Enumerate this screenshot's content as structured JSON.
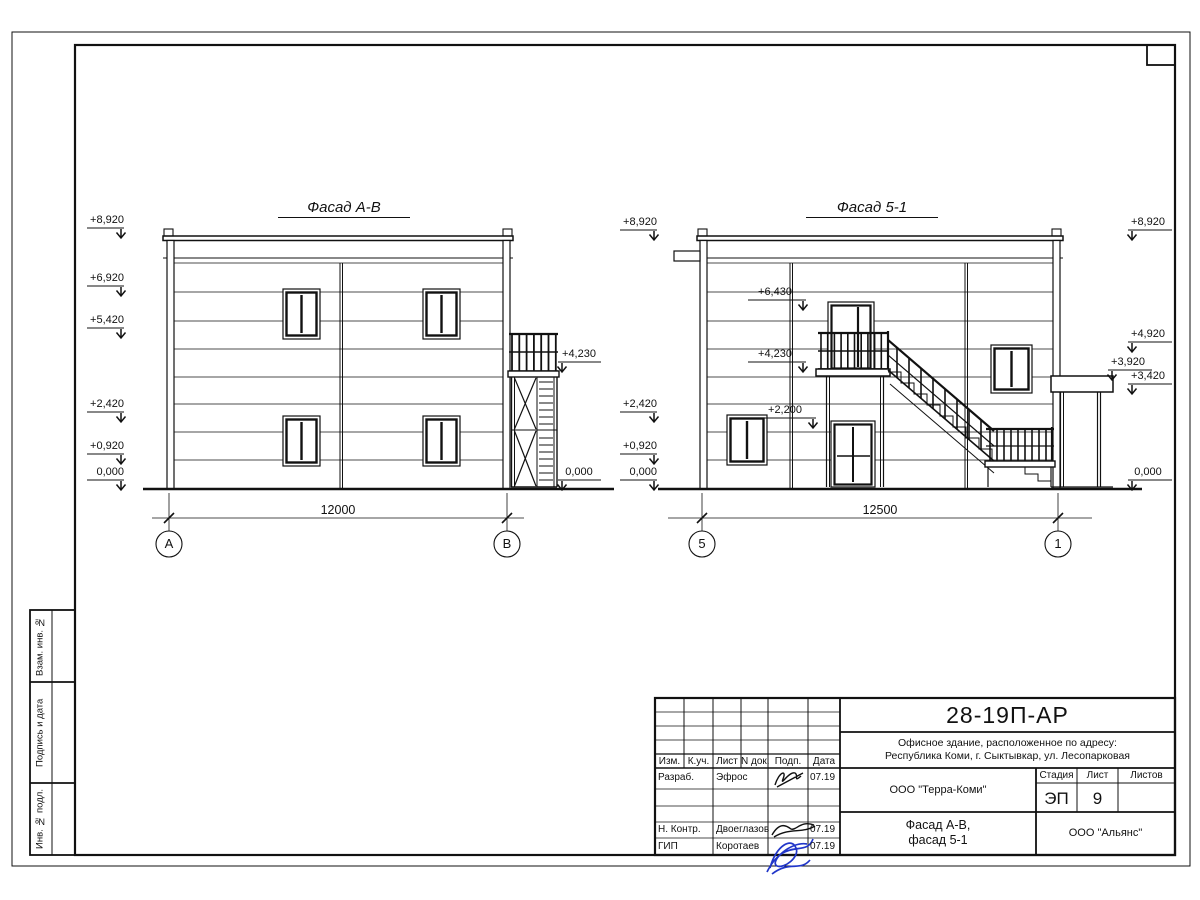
{
  "titleblock": {
    "doc_number": "28-19П-АР",
    "address_line1": "Офисное здание, расположенное по адресу:",
    "address_line2": "Республика Коми, г. Сыктывкар, ул. Лесопарковая",
    "columns": [
      "Изм.",
      "К.уч.",
      "Лист",
      "N док.",
      "Подп.",
      "Дата"
    ],
    "rows": [
      {
        "role": "Разраб.",
        "name": "Эфрос",
        "date": "07.19"
      },
      {
        "role": "Н. Контр.",
        "name": "Двоеглазов",
        "date": "07.19"
      },
      {
        "role": "ГИП",
        "name": "Коротаев",
        "date": "07.19"
      }
    ],
    "org": "ООО \"Терра-Коми\"",
    "stage_label": "Стадия",
    "sheet_label": "Лист",
    "sheets_label": "Листов",
    "stage": "ЭП",
    "sheet_number": "9",
    "sheets_total": "",
    "drawing_title_line1": "Фасад А-В,",
    "drawing_title_line2": "фасад 5-1",
    "contractor": "ООО \"Альянс\"",
    "signature_color": "#2136c9"
  },
  "side_stamp": {
    "cell1": "Взам. инв. №",
    "cell2": "Подпись и дата",
    "cell3": "Инв. № подл."
  },
  "facade_ab": {
    "title": "Фасад А-В",
    "dim": "12000",
    "axis_a": "А",
    "axis_b": "В",
    "lvl_8920": "+8,920",
    "lvl_6920": "+6,920",
    "lvl_5420": "+5,420",
    "lvl_2420": "+2,420",
    "lvl_0920": "+0,920",
    "lvl_0": "0,000",
    "lvl_4230": "+4,230",
    "lvl_0_right": "0,000"
  },
  "facade_51": {
    "title": "Фасад 5-1",
    "dim": "12500",
    "axis_5": "5",
    "axis_1": "1",
    "lvl_8920_l": "+8,920",
    "lvl_2420": "+2,420",
    "lvl_0920": "+0,920",
    "lvl_0_l": "0,000",
    "lvl_6430": "+6,430",
    "lvl_4230": "+4,230",
    "lvl_2200": "+2,200",
    "lvl_8920_r": "+8,920",
    "lvl_4920": "+4,920",
    "lvl_3920": "+3,920",
    "lvl_3420": "+3,420",
    "lvl_0_r": "0,000"
  }
}
